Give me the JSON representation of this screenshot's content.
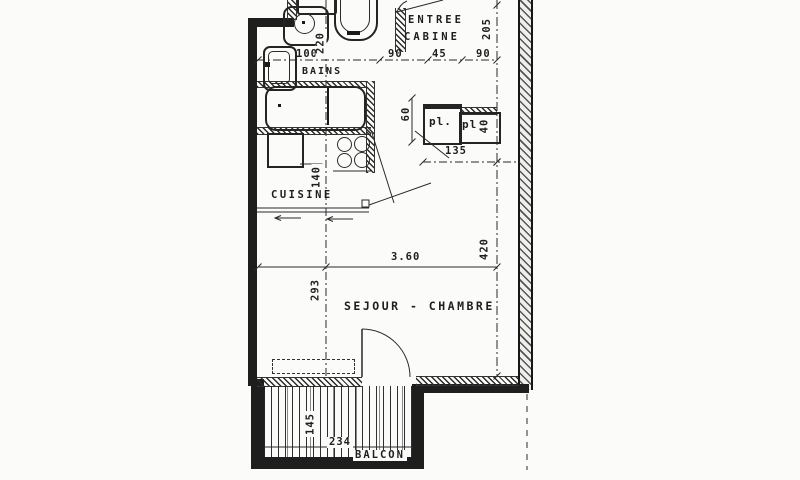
{
  "plan": {
    "rooms": {
      "entree_line1": "ENTREE",
      "entree_line2": "CABINE",
      "bains": "BAINS",
      "cuisine": "CUISINE",
      "sejour_chambre": "SEJOUR - CHAMBRE",
      "balcon": "BALCON"
    },
    "closets": {
      "left_label": "pl.",
      "right_label": "pl."
    },
    "dimensions": {
      "cabine_depth": "205",
      "bains_width": "100",
      "entree_seg_a": "90",
      "entree_seg_b": "45",
      "entree_seg_c": "90",
      "wc_depth": "220",
      "placard_depth": "60",
      "placard_right_width": "40",
      "placard_total_width": "135",
      "cuisine_width": "140",
      "sejour_width_m": "3.60",
      "sejour_depth": "420",
      "sejour_axis": "293",
      "balcon_depth": "145",
      "balcon_width": "234"
    },
    "colors": {
      "ink": "#1e1e1e",
      "paper": "#fbfbf9"
    }
  }
}
